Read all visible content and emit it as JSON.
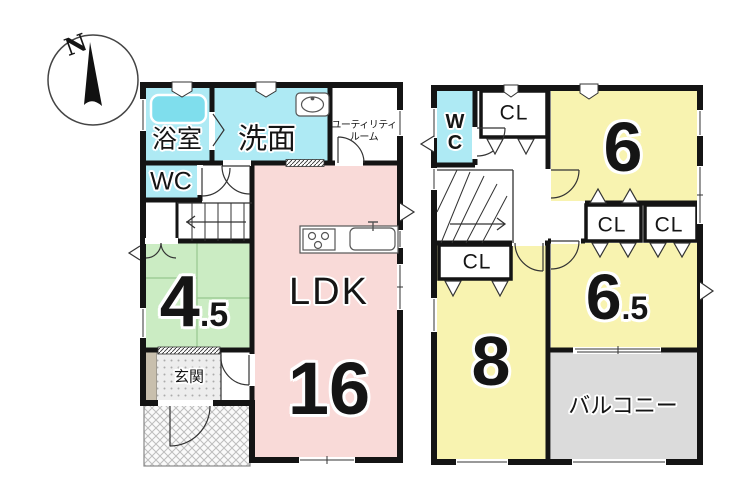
{
  "compass": {
    "north_label": "N"
  },
  "floor1": {
    "bathroom_label": "浴室",
    "washroom_label": "洗面",
    "utility_label_line1": "ユーティリティ",
    "utility_label_line2": "ルーム",
    "wc_label": "WC",
    "tatami_size_whole": "4",
    "tatami_size_fraction": ".5",
    "entrance_label": "玄関",
    "ldk_label": "LDK",
    "ldk_size": "16"
  },
  "floor2": {
    "wc_label_line1": "W",
    "wc_label_line2": "C",
    "closet_top_label": "CL",
    "room6_size": "6",
    "closet_a_label": "CL",
    "closet_b_label": "CL",
    "room65_size_whole": "6",
    "room65_size_fraction": ".5",
    "closet_room8_label": "CL",
    "room8_size": "8",
    "balcony_label": "バルコニー"
  },
  "palette": {
    "wet_area_cyan": "#aeeaf4",
    "bathtub_cyan": "#7fdeed",
    "ldk_pink": "#f9dad8",
    "tatami_green": "#cbecc3",
    "room_yellow": "#f8f3b0",
    "balcony_gray": "#dbdbdb",
    "entrance_tile_gray": "#ededed",
    "shoe_cabinet_beige": "#c8bfad",
    "wall_black": "#141414"
  }
}
